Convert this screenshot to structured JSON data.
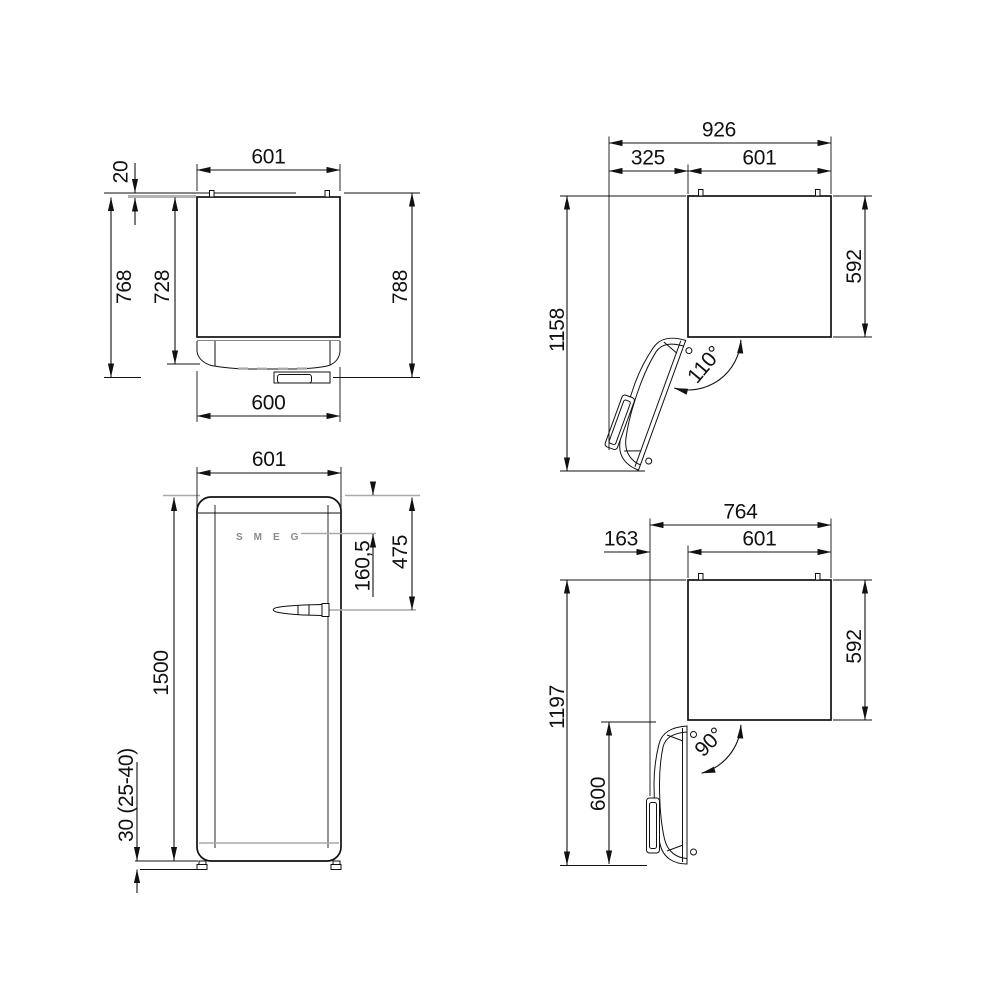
{
  "drawing_title": "refrigerator-installation-dimensions",
  "colors": {
    "line": "#111111",
    "gray": "#a9a9a9",
    "background": "#ffffff"
  },
  "top_view_closed": {
    "width_top": "601",
    "rear_wall_clearance": "20",
    "depth_with_handle": "768",
    "depth_body": "728",
    "depth_overall_from_wall": "788",
    "width_bottom": "600"
  },
  "top_view_open_110": {
    "overall_width": "926",
    "door_swing_clearance": "325",
    "cabinet_width": "601",
    "depth_door_open": "1158",
    "cabinet_depth": "592",
    "door_angle": "110°"
  },
  "front_view": {
    "width": "601",
    "top_to_logo": "160,5",
    "top_to_handle": "475",
    "height": "1500",
    "feet_height": "30 (25-40)",
    "logo": "SMEG"
  },
  "top_view_open_90": {
    "overall_width": "764",
    "door_protrusion": "163",
    "cabinet_width": "601",
    "depth_door_open": "1197",
    "cabinet_depth": "592",
    "door_depth": "600",
    "door_angle": "90°"
  }
}
